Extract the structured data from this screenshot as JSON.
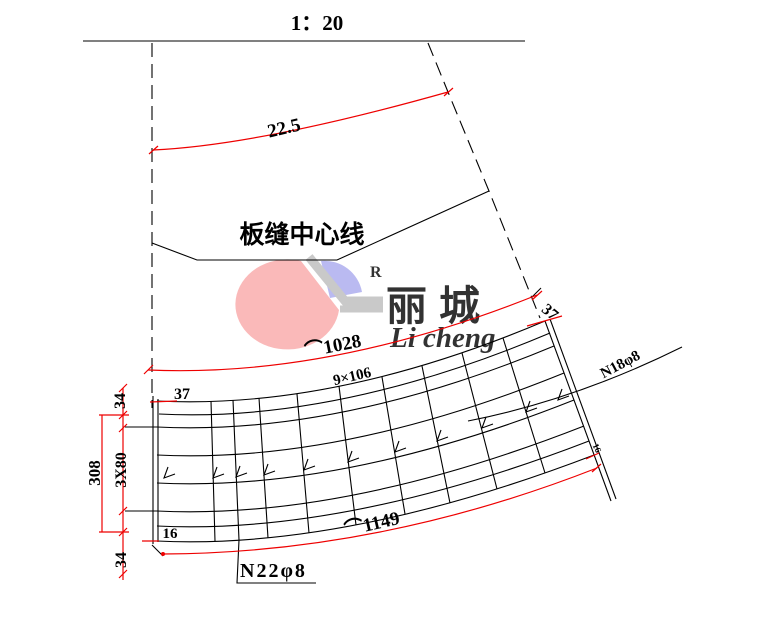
{
  "scale_label": "1：20",
  "annotations": {
    "arc_22_5": "22.5",
    "seam_center_line": "板缝中心线",
    "arc_len_top": "⌒1028",
    "spacing_top": "9×106",
    "dim_37_left": "37",
    "dim_37_right": "37",
    "bar_n18": "N18φ8",
    "dim_34_top": "34",
    "dim_308": "308",
    "dim_3x80": "3X80",
    "dim_16_left": "16",
    "dim_16_right": "16",
    "dim_34_bottom": "34",
    "arc_len_bottom": "⌒1149",
    "bar_n22": "N22φ8"
  },
  "watermark": {
    "registered_mark": "R",
    "brand_cn": "丽城",
    "brand_en": "Li cheng"
  },
  "colors": {
    "drawing_line": "#000000",
    "highlight_red": "#ee0000",
    "watermark_pink": "#f9a8a8",
    "watermark_blue": "#a9a9ee",
    "watermark_gray": "#bcbcbc",
    "watermark_text": "#b5b5b5"
  }
}
